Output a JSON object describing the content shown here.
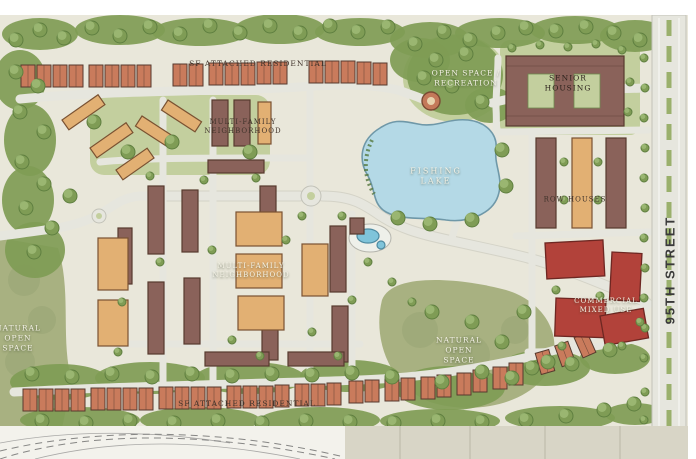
{
  "plan": {
    "labels": {
      "attached_residential_top": "SF Attached Residential",
      "multi_family_upper": "Multi-Family\nNeighborhood",
      "open_space_recreation": "Open Space /\nRecreation",
      "senior_housing": "Senior\nHousing",
      "fishing_lake": "Fishing\nLake",
      "row_houses": "Row Houses",
      "multi_family_center": "Multi-Family\nNeighborhood",
      "commercial_mixed_use": "Commercial\nMixed Use",
      "natural_open_space_west": "Natural\nOpen\nSpace",
      "natural_open_space_central": "Natural\nOpen\nSpace",
      "attached_residential_bottom": "SF Attached Residential",
      "street_95th": "95TH STREET"
    }
  },
  "colors": {
    "plan_wash": "#e9e7da",
    "tree_green": "#7f9c55",
    "tree_dark": "#5f7f40",
    "lawn_green": "#c3cf9e",
    "olive_open_space": "#a8b181",
    "road_grey": "#e6e6de",
    "road_edge": "#c2c2b8",
    "lake_blue": "#b4d9e6",
    "lake_edge": "#6f98a8",
    "building_brown": "#8a625a",
    "building_dark_outline": "#573a2e",
    "roof_terracotta": "#c97b5c",
    "building_tan": "#e2b073",
    "commercial_red": "#b2423a",
    "label_dark": "#40332b",
    "label_light": "#f4f2e6"
  }
}
